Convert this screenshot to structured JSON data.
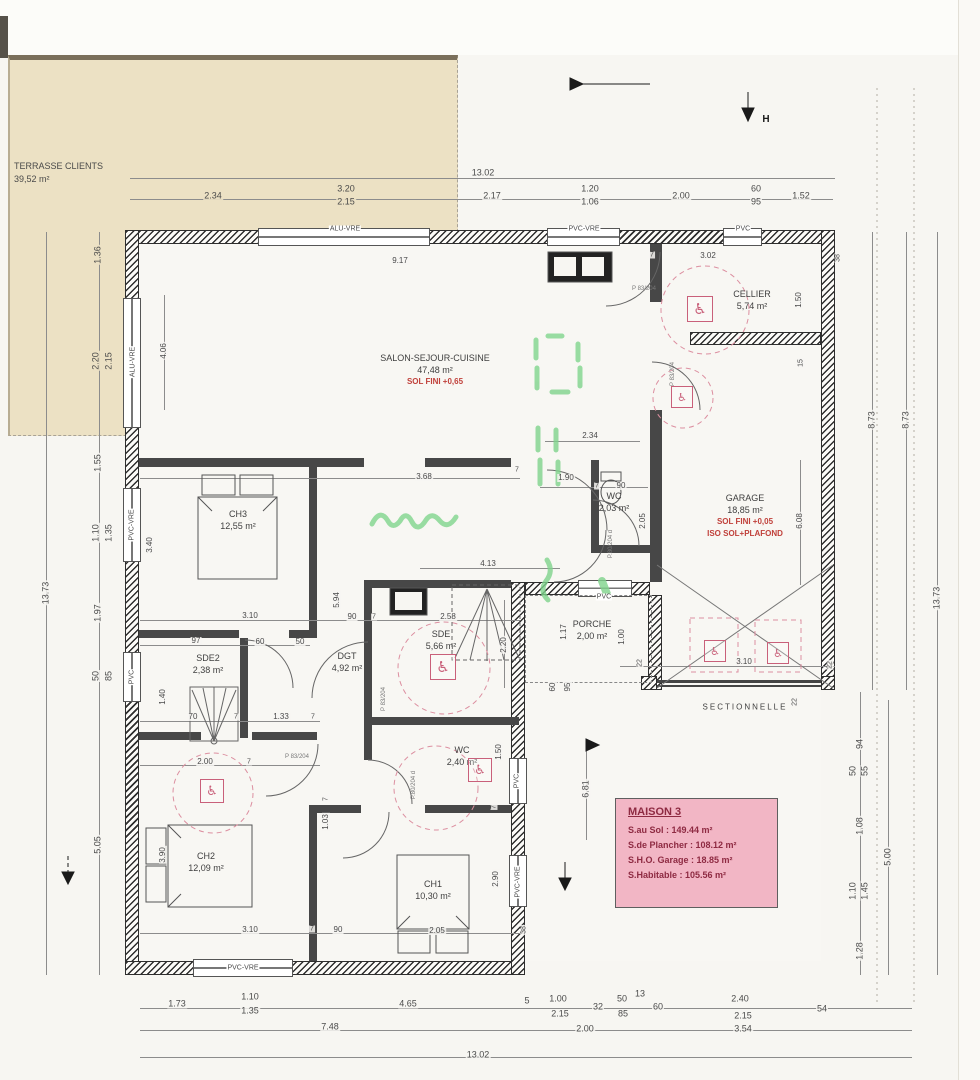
{
  "terrace": {
    "label": "TERRASSE CLIENTS",
    "area": "39,52 m²"
  },
  "labels": {
    "sectionnelle": "SECTIONNELLE"
  },
  "info_box": {
    "title": "MAISON 3",
    "rows": [
      "S.au Sol : 149.44 m²",
      "S.de Plancher : 108.12 m²",
      "S.H.O. Garage : 18.85 m²",
      "S.Habitable : 105.56 m²"
    ]
  },
  "colors": {
    "accent_red": "#c0403a",
    "pink_box": "#f2b6c5",
    "maroon": "#8e2a42",
    "terrace_beige": "#ece1c4",
    "green_marker": "#7fd48c",
    "pink_dashed": "#dc8fa0"
  },
  "icons": {
    "wheelchair": "♿"
  },
  "rooms": [
    {
      "id": "salon",
      "name": "SALON-SEJOUR-CUISINE",
      "area": "47,48 m²",
      "notes": [
        "SOL FINI +0,65"
      ],
      "x": 435,
      "y": 352
    },
    {
      "id": "cellier",
      "name": "CELLIER",
      "area": "5,74 m²",
      "notes": [],
      "x": 752,
      "y": 288
    },
    {
      "id": "garage",
      "name": "GARAGE",
      "area": "18,85 m²",
      "notes": [
        "SOL FINI +0,05",
        "ISO SOL+PLAFOND"
      ],
      "x": 745,
      "y": 492
    },
    {
      "id": "ch3",
      "name": "CH3",
      "area": "12,55 m²",
      "notes": [],
      "x": 238,
      "y": 508
    },
    {
      "id": "sde2",
      "name": "SDE2",
      "area": "2,38 m²",
      "notes": [],
      "x": 208,
      "y": 652
    },
    {
      "id": "dgt",
      "name": "DGT",
      "area": "4,92 m²",
      "notes": [],
      "x": 347,
      "y": 650
    },
    {
      "id": "sde",
      "name": "SDE",
      "area": "5,66 m²",
      "notes": [],
      "x": 441,
      "y": 628
    },
    {
      "id": "wc1",
      "name": "WC",
      "area": "2,03 m²",
      "notes": [],
      "x": 614,
      "y": 490
    },
    {
      "id": "wc2",
      "name": "WC",
      "area": "2,40 m²",
      "notes": [],
      "x": 462,
      "y": 744
    },
    {
      "id": "porche",
      "name": "PORCHE",
      "area": "2,00 m²",
      "notes": [],
      "x": 592,
      "y": 618
    },
    {
      "id": "ch2",
      "name": "CH2",
      "area": "12,09 m²",
      "notes": [],
      "x": 206,
      "y": 850
    },
    {
      "id": "ch1",
      "name": "CH1",
      "area": "10,30 m²",
      "notes": [],
      "x": 433,
      "y": 878
    }
  ],
  "window_labels": [
    {
      "t": "ALU-VRE",
      "x": 345,
      "y": 229
    },
    {
      "t": "PVC-VRE",
      "x": 584,
      "y": 229
    },
    {
      "t": "PVC",
      "x": 743,
      "y": 229
    },
    {
      "t": "ALU-VRE",
      "x": 133,
      "y": 362,
      "r": 1
    },
    {
      "t": "PVC-VRE",
      "x": 132,
      "y": 525,
      "r": 1
    },
    {
      "t": "PVC",
      "x": 132,
      "y": 677,
      "r": 1
    },
    {
      "t": "PVC-VRE",
      "x": 243,
      "y": 968
    },
    {
      "t": "PVC",
      "x": 517,
      "y": 781,
      "r": 1
    },
    {
      "t": "PVC-VRE",
      "x": 518,
      "y": 882,
      "r": 1
    },
    {
      "t": "PVC",
      "x": 604,
      "y": 597
    }
  ],
  "door_labels": [
    {
      "t": "P 83/204",
      "x": 644,
      "y": 289
    },
    {
      "t": "P 83/204",
      "x": 673,
      "y": 374,
      "r": 1
    },
    {
      "t": "P 83/204",
      "x": 384,
      "y": 699,
      "r": 1
    },
    {
      "t": "P 83/204",
      "x": 297,
      "y": 757
    },
    {
      "t": "P.80/204 d",
      "x": 611,
      "y": 544,
      "r": 1
    },
    {
      "t": "P.80/204 d",
      "x": 414,
      "y": 785,
      "r": 1
    }
  ],
  "markers": [
    {
      "t": "H",
      "x": 766,
      "y": 120
    }
  ],
  "wheelchair_symbols": [
    {
      "x": 687,
      "y": 296,
      "s": 24
    },
    {
      "x": 671,
      "y": 386,
      "s": 20
    },
    {
      "x": 430,
      "y": 654,
      "s": 24
    },
    {
      "x": 468,
      "y": 758,
      "s": 22
    },
    {
      "x": 200,
      "y": 779,
      "s": 22
    },
    {
      "x": 704,
      "y": 640,
      "s": 20
    },
    {
      "x": 767,
      "y": 642,
      "s": 20
    }
  ],
  "dims": [
    {
      "t": "13.02",
      "x": 483,
      "y": 173
    },
    {
      "t": "2.34",
      "x": 213,
      "y": 196,
      "b": 1
    },
    {
      "t": "3.20",
      "x": 346,
      "y": 189,
      "b": 1
    },
    {
      "t": "2.15",
      "x": 346,
      "y": 202,
      "b": 1
    },
    {
      "t": "2.17",
      "x": 492,
      "y": 196
    },
    {
      "t": "1.20",
      "x": 590,
      "y": 189
    },
    {
      "t": "1.06",
      "x": 590,
      "y": 202
    },
    {
      "t": "2.00",
      "x": 681,
      "y": 196
    },
    {
      "t": "60",
      "x": 756,
      "y": 189
    },
    {
      "t": "95",
      "x": 756,
      "y": 202
    },
    {
      "t": "1.52",
      "x": 801,
      "y": 196
    },
    {
      "t": "9.17",
      "x": 400,
      "y": 261,
      "s": 8
    },
    {
      "t": "3.02",
      "x": 708,
      "y": 256,
      "s": 8
    },
    {
      "t": "38",
      "x": 838,
      "y": 258,
      "r": 1,
      "s": 7
    },
    {
      "t": "7",
      "x": 652,
      "y": 255,
      "s": 7
    },
    {
      "t": "1.50",
      "x": 799,
      "y": 300,
      "r": 1,
      "s": 8
    },
    {
      "t": "15",
      "x": 801,
      "y": 363,
      "r": 1,
      "s": 7
    },
    {
      "t": "2.34",
      "x": 590,
      "y": 436,
      "s": 8
    },
    {
      "t": "3.68",
      "x": 424,
      "y": 477,
      "s": 8
    },
    {
      "t": "7",
      "x": 517,
      "y": 470,
      "s": 7
    },
    {
      "t": "1.90",
      "x": 566,
      "y": 478,
      "s": 8
    },
    {
      "t": "7",
      "x": 597,
      "y": 486,
      "s": 7
    },
    {
      "t": "90",
      "x": 621,
      "y": 486,
      "s": 8
    },
    {
      "t": "2.05",
      "x": 643,
      "y": 521,
      "r": 1,
      "s": 8
    },
    {
      "t": "4.13",
      "x": 488,
      "y": 564,
      "s": 8
    },
    {
      "t": "5.94",
      "x": 337,
      "y": 600,
      "r": 1,
      "s": 8
    },
    {
      "t": "3.10",
      "x": 250,
      "y": 616,
      "s": 8
    },
    {
      "t": "90",
      "x": 352,
      "y": 617,
      "s": 8
    },
    {
      "t": "7",
      "x": 374,
      "y": 617,
      "s": 7
    },
    {
      "t": "2.58",
      "x": 448,
      "y": 617,
      "s": 8
    },
    {
      "t": "2.20",
      "x": 504,
      "y": 645,
      "r": 1,
      "s": 8
    },
    {
      "t": "97",
      "x": 196,
      "y": 641,
      "s": 8
    },
    {
      "t": "60",
      "x": 260,
      "y": 642,
      "s": 8
    },
    {
      "t": "50",
      "x": 300,
      "y": 642,
      "s": 8
    },
    {
      "t": "1.40",
      "x": 163,
      "y": 697,
      "r": 1,
      "s": 8
    },
    {
      "t": "70",
      "x": 193,
      "y": 717,
      "s": 8
    },
    {
      "t": "7",
      "x": 236,
      "y": 717,
      "s": 7
    },
    {
      "t": "1.33",
      "x": 281,
      "y": 717,
      "s": 8
    },
    {
      "t": "7",
      "x": 313,
      "y": 717,
      "s": 7
    },
    {
      "t": "2.00",
      "x": 205,
      "y": 762,
      "s": 8
    },
    {
      "t": "7",
      "x": 249,
      "y": 762,
      "s": 7
    },
    {
      "t": "7",
      "x": 326,
      "y": 799,
      "r": 1,
      "s": 7
    },
    {
      "t": "1.03",
      "x": 326,
      "y": 822,
      "r": 1,
      "s": 8
    },
    {
      "t": "1.50",
      "x": 499,
      "y": 752,
      "r": 1,
      "s": 8
    },
    {
      "t": "7",
      "x": 494,
      "y": 807,
      "r": 1,
      "s": 7
    },
    {
      "t": "3.90",
      "x": 163,
      "y": 855,
      "r": 1,
      "s": 8
    },
    {
      "t": "3.10",
      "x": 250,
      "y": 930,
      "s": 8
    },
    {
      "t": "7",
      "x": 312,
      "y": 929,
      "s": 7
    },
    {
      "t": "90",
      "x": 338,
      "y": 930,
      "s": 8
    },
    {
      "t": "2.05",
      "x": 437,
      "y": 931,
      "s": 8
    },
    {
      "t": "38",
      "x": 524,
      "y": 930,
      "r": 1,
      "s": 7
    },
    {
      "t": "2.90",
      "x": 496,
      "y": 879,
      "r": 1,
      "s": 8
    },
    {
      "t": "4.06",
      "x": 164,
      "y": 351,
      "r": 1,
      "s": 8
    },
    {
      "t": "3.40",
      "x": 150,
      "y": 545,
      "r": 1,
      "s": 8
    },
    {
      "t": "1.36",
      "x": 98,
      "y": 255,
      "r": 1,
      "b": 1
    },
    {
      "t": "2.20",
      "x": 96,
      "y": 361,
      "r": 1,
      "b": 1
    },
    {
      "t": "2.15",
      "x": 109,
      "y": 361,
      "r": 1,
      "b": 1
    },
    {
      "t": "1.55",
      "x": 98,
      "y": 463,
      "r": 1
    },
    {
      "t": "1.10",
      "x": 96,
      "y": 533,
      "r": 1
    },
    {
      "t": "1.35",
      "x": 109,
      "y": 533,
      "r": 1
    },
    {
      "t": "13.73",
      "x": 46,
      "y": 593,
      "r": 1
    },
    {
      "t": "1.97",
      "x": 98,
      "y": 613,
      "r": 1
    },
    {
      "t": "50",
      "x": 96,
      "y": 676,
      "r": 1
    },
    {
      "t": "85",
      "x": 109,
      "y": 676,
      "r": 1
    },
    {
      "t": "5.05",
      "x": 98,
      "y": 845,
      "r": 1
    },
    {
      "t": "8.73",
      "x": 872,
      "y": 420,
      "r": 1
    },
    {
      "t": "8.73",
      "x": 906,
      "y": 420,
      "r": 1
    },
    {
      "t": "13.73",
      "x": 937,
      "y": 598,
      "r": 1
    },
    {
      "t": "6.08",
      "x": 800,
      "y": 521,
      "r": 1,
      "s": 8
    },
    {
      "t": "1.17",
      "x": 564,
      "y": 632,
      "r": 1,
      "s": 8
    },
    {
      "t": "1.00",
      "x": 622,
      "y": 637,
      "r": 1,
      "s": 8
    },
    {
      "t": "60",
      "x": 553,
      "y": 687,
      "r": 1,
      "s": 8
    },
    {
      "t": "95",
      "x": 568,
      "y": 687,
      "r": 1,
      "s": 8
    },
    {
      "t": "22",
      "x": 640,
      "y": 663,
      "r": 1,
      "s": 7
    },
    {
      "t": "3.10",
      "x": 744,
      "y": 662,
      "s": 8
    },
    {
      "t": "22",
      "x": 830,
      "y": 665,
      "r": 1,
      "s": 7
    },
    {
      "t": "22",
      "x": 795,
      "y": 702,
      "r": 1,
      "s": 7
    },
    {
      "t": "6.81",
      "x": 586,
      "y": 789,
      "r": 1
    },
    {
      "t": "94",
      "x": 860,
      "y": 744,
      "r": 1
    },
    {
      "t": "50",
      "x": 853,
      "y": 771,
      "r": 1
    },
    {
      "t": "55",
      "x": 865,
      "y": 771,
      "r": 1
    },
    {
      "t": "1.08",
      "x": 860,
      "y": 826,
      "r": 1
    },
    {
      "t": "1.10",
      "x": 853,
      "y": 891,
      "r": 1
    },
    {
      "t": "1.45",
      "x": 865,
      "y": 891,
      "r": 1
    },
    {
      "t": "1.28",
      "x": 860,
      "y": 951,
      "r": 1
    },
    {
      "t": "5.00",
      "x": 888,
      "y": 857,
      "r": 1
    },
    {
      "t": "1.73",
      "x": 177,
      "y": 1004
    },
    {
      "t": "1.10",
      "x": 250,
      "y": 997
    },
    {
      "t": "1.35",
      "x": 250,
      "y": 1011
    },
    {
      "t": "4.65",
      "x": 408,
      "y": 1004
    },
    {
      "t": "5",
      "x": 527,
      "y": 1001
    },
    {
      "t": "1.00",
      "x": 558,
      "y": 999
    },
    {
      "t": "2.15",
      "x": 560,
      "y": 1014
    },
    {
      "t": "32",
      "x": 598,
      "y": 1007
    },
    {
      "t": "50",
      "x": 622,
      "y": 999
    },
    {
      "t": "85",
      "x": 623,
      "y": 1014
    },
    {
      "t": "13",
      "x": 640,
      "y": 994
    },
    {
      "t": "60",
      "x": 658,
      "y": 1007
    },
    {
      "t": "2.40",
      "x": 740,
      "y": 999
    },
    {
      "t": "2.15",
      "x": 743,
      "y": 1016
    },
    {
      "t": "54",
      "x": 822,
      "y": 1009
    },
    {
      "t": "7.48",
      "x": 330,
      "y": 1027
    },
    {
      "t": "2.00",
      "x": 585,
      "y": 1029
    },
    {
      "t": "3.54",
      "x": 743,
      "y": 1029
    },
    {
      "t": "13.02",
      "x": 478,
      "y": 1055
    }
  ]
}
